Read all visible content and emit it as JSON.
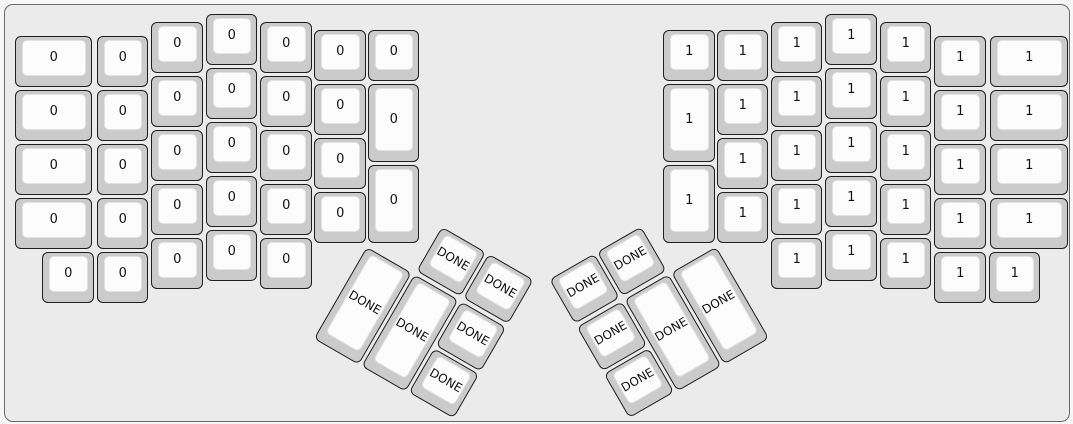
{
  "canvas": {
    "background": "#ebebeb",
    "border_color": "#6a6a6a",
    "outer_background": "#f7f7f7"
  },
  "key_style": {
    "cap_color": "#cbcbcb",
    "cap_border": "#1f1f1f",
    "face_color": "#fcfcfc",
    "face_border": "#e3e3e3",
    "text_color": "#111111"
  },
  "keys": {
    "groups": [
      {
        "name": "left-half",
        "label": "0",
        "keys": [
          [
            10,
            31,
            77.5,
            51
          ],
          [
            10,
            85,
            77.5,
            51
          ],
          [
            10,
            139,
            77.5,
            51
          ],
          [
            10,
            193,
            77.5,
            51
          ],
          [
            37.5,
            247,
            51.5,
            51
          ],
          [
            92,
            31,
            51.5,
            51
          ],
          [
            92,
            85,
            51.5,
            51
          ],
          [
            92,
            139,
            51.5,
            51
          ],
          [
            92,
            193,
            51.5,
            51
          ],
          [
            92,
            247,
            51.5,
            51
          ],
          [
            146.5,
            17,
            51.5,
            51
          ],
          [
            146.5,
            71,
            51.5,
            51
          ],
          [
            146.5,
            125,
            51.5,
            51
          ],
          [
            146.5,
            179,
            51.5,
            51
          ],
          [
            146.5,
            233,
            51.5,
            51
          ],
          [
            201,
            9,
            51.5,
            51
          ],
          [
            201,
            63,
            51.5,
            51
          ],
          [
            201,
            117,
            51.5,
            51
          ],
          [
            201,
            171,
            51.5,
            51
          ],
          [
            201,
            225,
            51.5,
            51
          ],
          [
            255.5,
            17,
            51.5,
            51
          ],
          [
            255.5,
            71,
            51.5,
            51
          ],
          [
            255.5,
            125,
            51.5,
            51
          ],
          [
            255.5,
            179,
            51.5,
            51
          ],
          [
            255.5,
            233,
            51.5,
            51
          ],
          [
            309.5,
            25,
            51.5,
            51
          ],
          [
            309.5,
            79,
            51.5,
            51
          ],
          [
            309.5,
            133,
            51.5,
            51
          ],
          [
            309.5,
            187,
            51.5,
            51
          ],
          [
            363,
            25,
            51.5,
            51
          ],
          [
            363,
            79,
            51.5,
            78
          ],
          [
            363,
            160,
            51.5,
            78
          ]
        ]
      },
      {
        "name": "right-half",
        "label": "1",
        "keys": [
          [
            658.5,
            25,
            51.5,
            51
          ],
          [
            658.5,
            79,
            51.5,
            78
          ],
          [
            658.5,
            160,
            51.5,
            78
          ],
          [
            712,
            25,
            51.5,
            51
          ],
          [
            712,
            79,
            51.5,
            51
          ],
          [
            712,
            133,
            51.5,
            51
          ],
          [
            712,
            187,
            51.5,
            51
          ],
          [
            766,
            17,
            51.5,
            51
          ],
          [
            766,
            71,
            51.5,
            51
          ],
          [
            766,
            125,
            51.5,
            51
          ],
          [
            766,
            179,
            51.5,
            51
          ],
          [
            766,
            233,
            51.5,
            51
          ],
          [
            820.5,
            9,
            51.5,
            51
          ],
          [
            820.5,
            63,
            51.5,
            51
          ],
          [
            820.5,
            117,
            51.5,
            51
          ],
          [
            820.5,
            171,
            51.5,
            51
          ],
          [
            820.5,
            225,
            51.5,
            51
          ],
          [
            875,
            17,
            51.5,
            51
          ],
          [
            875,
            71,
            51.5,
            51
          ],
          [
            875,
            125,
            51.5,
            51
          ],
          [
            875,
            179,
            51.5,
            51
          ],
          [
            875,
            233,
            51.5,
            51
          ],
          [
            929.5,
            31,
            51.5,
            51
          ],
          [
            929.5,
            85,
            51.5,
            51
          ],
          [
            929.5,
            139,
            51.5,
            51
          ],
          [
            929.5,
            193,
            51.5,
            51
          ],
          [
            929.5,
            247,
            51.5,
            51
          ],
          [
            985.5,
            31,
            77.5,
            51
          ],
          [
            985.5,
            85,
            77.5,
            51
          ],
          [
            985.5,
            139,
            77.5,
            51
          ],
          [
            985.5,
            193,
            77.5,
            51
          ],
          [
            984,
            247,
            51.5,
            51
          ]
        ]
      },
      {
        "name": "left-thumb-cluster",
        "label": "DONE",
        "rotation": {
          "x": 362,
          "y": 187.5,
          "angle": 30,
          "origin_x": 0,
          "origin_y": 54.5
        },
        "keys": [
          [
            54.5,
            0,
            51.5,
            51
          ],
          [
            109,
            0,
            51.5,
            51
          ],
          [
            0,
            54.5,
            51.5,
            106
          ],
          [
            54.5,
            54.5,
            51.5,
            106
          ],
          [
            109,
            54.5,
            51.5,
            51
          ],
          [
            109,
            109,
            51.5,
            51
          ]
        ]
      },
      {
        "name": "right-thumb-cluster",
        "label": "DONE",
        "rotation": {
          "x": 547.5,
          "y": 187.5,
          "angle": -30,
          "origin_x": 163.5,
          "origin_y": 54.5
        },
        "keys": [
          [
            3,
            0,
            51.5,
            51
          ],
          [
            57.5,
            0,
            51.5,
            51
          ],
          [
            3,
            54.5,
            51.5,
            51
          ],
          [
            57.5,
            54.5,
            51.5,
            106
          ],
          [
            112,
            54.5,
            51.5,
            106
          ],
          [
            3,
            109,
            51.5,
            51
          ]
        ]
      }
    ]
  }
}
